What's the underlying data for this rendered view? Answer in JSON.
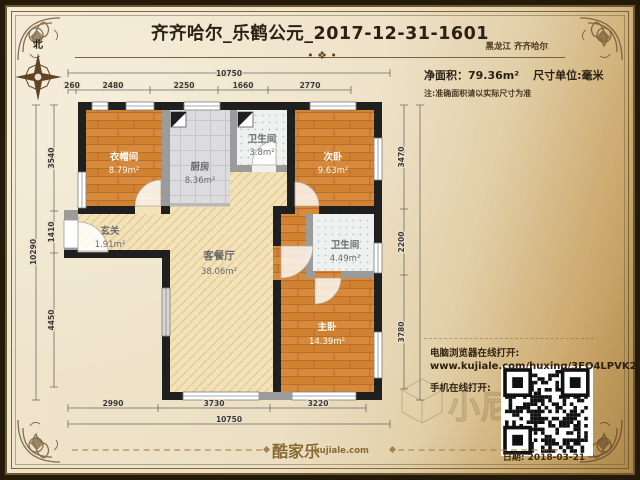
{
  "header": {
    "title": "齐齐哈尔_乐鹤公元_2017-12-31-1601",
    "region": "黑龙江 齐齐哈尔",
    "medallion": "• ❖ •"
  },
  "info": {
    "net_area_label": "净面积：79.36m²",
    "unit_label": "尺寸单位:毫米",
    "note": "注:准确面积请以实际尺寸为准"
  },
  "compass": {
    "north_label": "北"
  },
  "rooms": {
    "cloakroom": {
      "name": "衣帽间",
      "area": "8.79m²"
    },
    "kitchen": {
      "name": "厨房",
      "area": "8.36m²"
    },
    "bath_small": {
      "name": "卫生间",
      "area": "3.8m²"
    },
    "bedroom2": {
      "name": "次卧",
      "area": "9.63m²"
    },
    "entry": {
      "name": "玄关",
      "area": "1.91m²"
    },
    "living": {
      "name": "客餐厅",
      "area": "38.06m²"
    },
    "bath_main": {
      "name": "卫生间",
      "area": "4.49m²"
    },
    "bedroom_master": {
      "name": "主卧",
      "area": "14.39m²"
    }
  },
  "dimensions": {
    "top_total": "10750",
    "top_segments": [
      "260",
      "2480",
      "2250",
      "1660",
      "2770"
    ],
    "bottom_segments": [
      "2990",
      "3730",
      "3220"
    ],
    "bottom_total": "10750",
    "left_total": "10290",
    "left_segments": [
      "3540",
      "1410",
      "4450"
    ],
    "right_segments": [
      "3470",
      "2200",
      "3780"
    ],
    "right_total": "10290"
  },
  "links": {
    "pc_label": "电脑浏览器在线打开:",
    "url": "www.kujiale.com/huxing/3FO4LPVK28OT",
    "mobile_label": "手机在线打开:"
  },
  "footer": {
    "brand": "酷家乐",
    "brand_domain": "kujiale.com",
    "date": "日期: 2018-03-21"
  },
  "watermark": "小尼",
  "colors": {
    "wall": "#1f1f1f",
    "partition": "#9b9b9b",
    "wood_floor": "#d78a3c",
    "tile_floor": "#dcdcde",
    "hatch_floor": "#f3e2b8",
    "paper": "#ece1c8",
    "frame_brown": "#6d5830"
  }
}
